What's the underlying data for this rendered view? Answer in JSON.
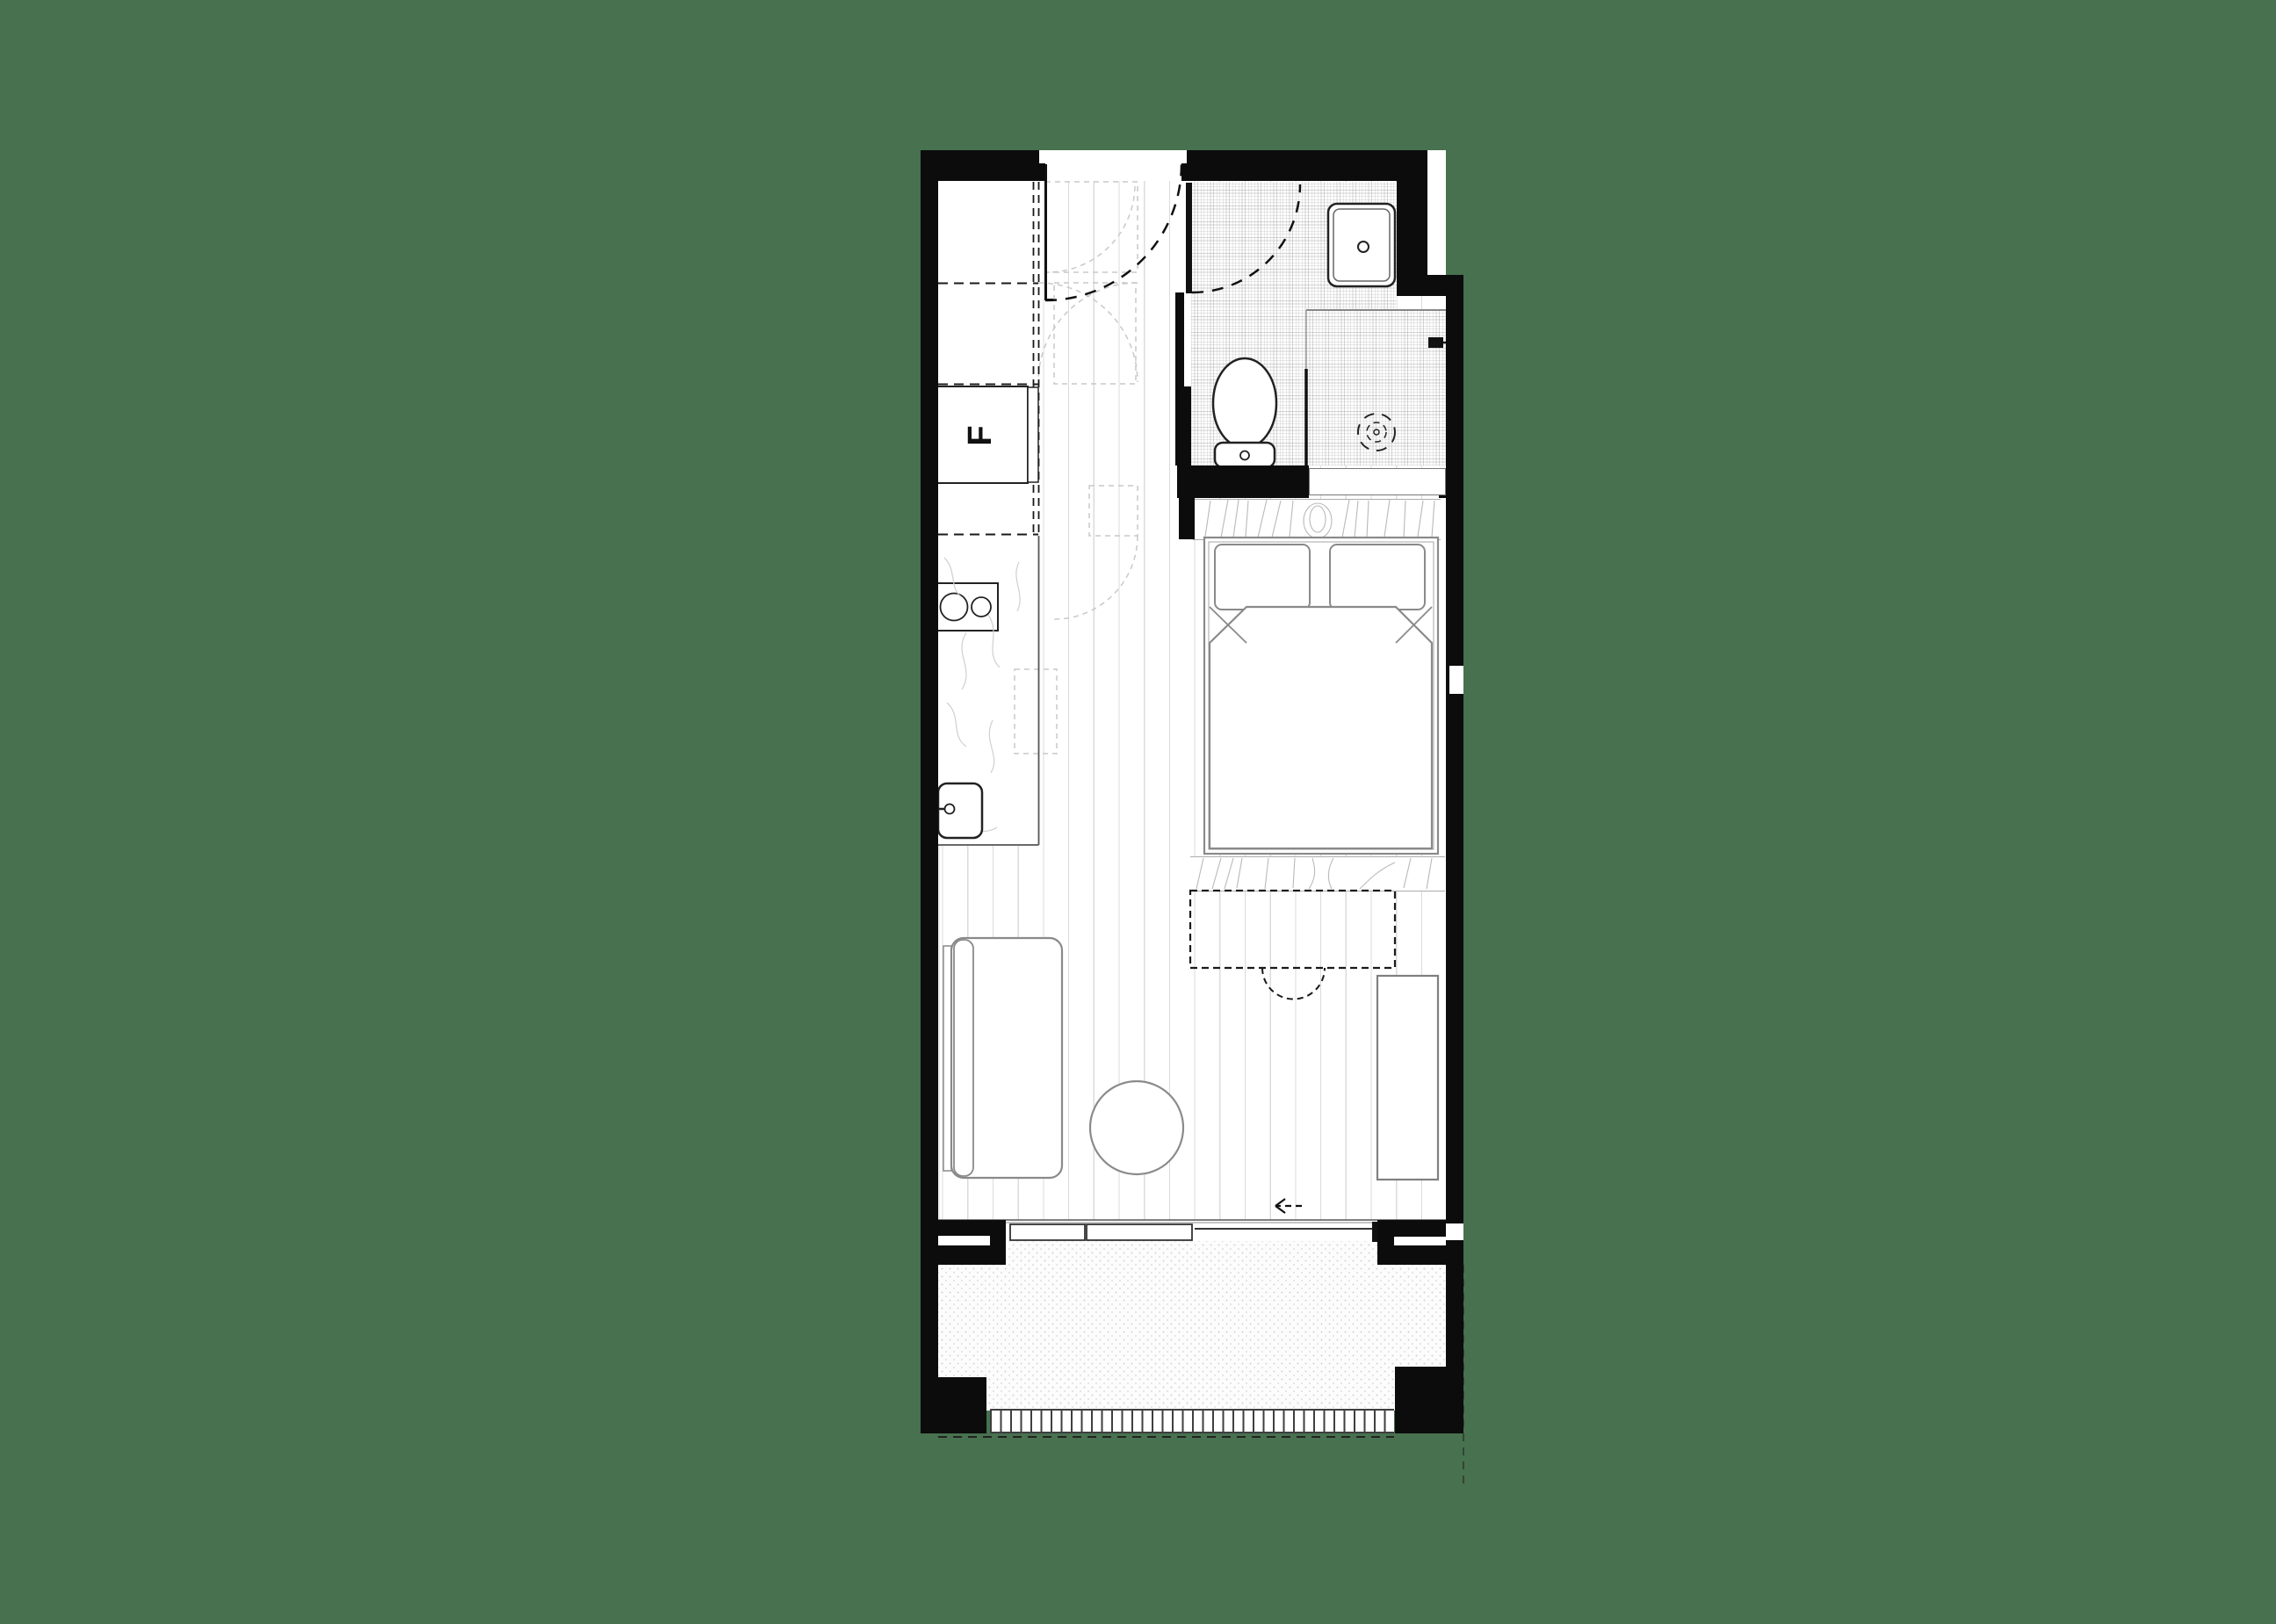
{
  "drawing": {
    "type": "studio-apartment-floor-plan",
    "fridge_label": "F"
  },
  "palette": {
    "background": "#47714F",
    "wall": "#0c0c0c",
    "furniture_line": "#8a8a8a",
    "fixture_line": "#222222",
    "floorboard_line": "#d9d9d9",
    "tile_line": "#c9c9c9",
    "wood_grain": "#b9b9b9",
    "dark_dash": "#1a1a1a",
    "light_dash": "#c9c9c9",
    "grate": "#3f3f3f"
  },
  "features": [
    "entry-door",
    "entry-door-swing",
    "kitchen-joinery",
    "fridge",
    "cooktop",
    "kitchen-sink",
    "kitchen-bench",
    "bathroom",
    "bathroom-door",
    "vanity-basin",
    "toilet",
    "shower",
    "shower-screen",
    "floor-drain",
    "wardrobe-joinery",
    "bed",
    "pillows",
    "duvet",
    "fold-down-desk",
    "desk-chair",
    "shelving-unit",
    "sofa",
    "round-coffee-table",
    "sliding-glass-door",
    "door-slide-arrow",
    "balcony",
    "drainage-grate"
  ]
}
